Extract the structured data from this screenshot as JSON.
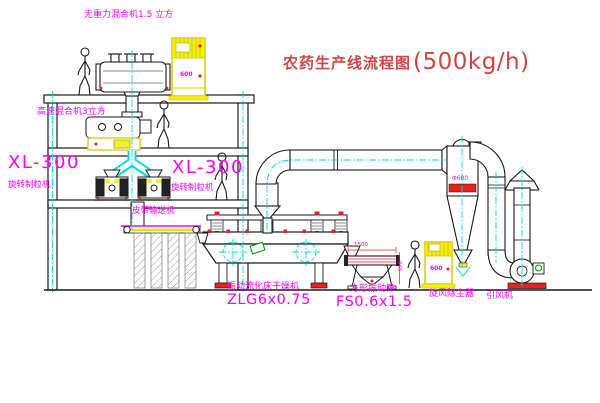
{
  "title": {
    "name": "农药生产线流程图",
    "capacity": "(500kg/h)"
  },
  "labels": {
    "gravity_mixer": "无重力混合机1.5 立方",
    "high_speed_mixer": "高速混合机3立方",
    "granulator_left_model": "XL-300",
    "granulator_left_name": "旋转制粒机",
    "granulator_right_model": "XL-300",
    "granulator_right_name": "旋转制粒机",
    "belt_conveyor": "皮带输送机",
    "dryer_name": "振动流化床干燥机",
    "dryer_model": "ZLG6x0.75",
    "sieve_name": "方形振动筛",
    "sieve_model": "FS0.6x1.5",
    "cyclone": "旋风除尘器",
    "fan": "引风机"
  },
  "dimensions": {
    "cyclone_diameter": "Φ600",
    "sieve_width": "1500",
    "sieve_depth": "945",
    "cabinet1_mark": "600",
    "cabinet2_mark": "600"
  },
  "colors": {
    "label_magenta": "#ff00ff",
    "title_red": "#cf4545",
    "accent_red": "#e82020",
    "equipment_yellow": "#f2ee12",
    "centerline_cyan": "#00dcdc",
    "detail_green": "#00a400",
    "line_black": "#1a1a1a",
    "background": "#ffffff"
  }
}
